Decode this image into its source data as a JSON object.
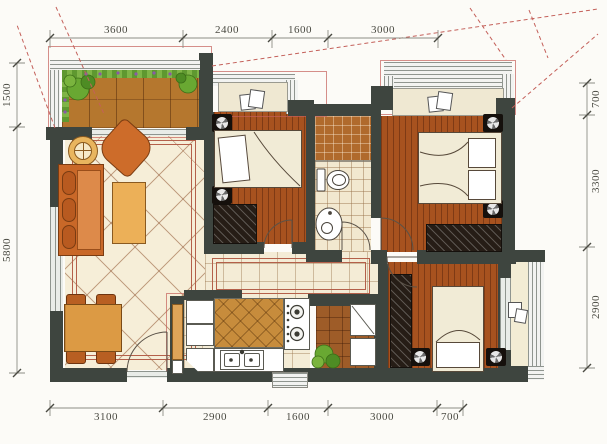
{
  "figure": {
    "type": "apartment-floor-plan"
  },
  "dims": {
    "top": [
      "3600",
      "2400",
      "1600",
      "3000"
    ],
    "bottom": [
      "3100",
      "2900",
      "1600",
      "3000",
      "700"
    ],
    "left": [
      "1500",
      "5800"
    ],
    "right": [
      "700",
      "3300",
      "2900"
    ]
  },
  "colors": {
    "wall": "#3e453f",
    "wood_floor": "#a7521f",
    "deck_wood": "#b5772e",
    "beige_tile": "#f6eed8",
    "counter_wood": "#c78c3c",
    "sofa_orange": "#cd6c2a",
    "table_wood": "#dc9a44",
    "bed_linen": "#f1ebd6",
    "wardrobe": "#261d16",
    "plant_green": "#69a832",
    "accent_red_line": "#c4605a",
    "dimension_text": "#4a4a42"
  },
  "icons": {
    "nightstand": "fan-circle",
    "bay_books": "stacked-squares",
    "plant": "leaf-cluster",
    "stove": "two-burners",
    "kitchen_sink": "double-basin",
    "toilet": "tank-and-bowl",
    "washbasin": "oval-basin"
  }
}
